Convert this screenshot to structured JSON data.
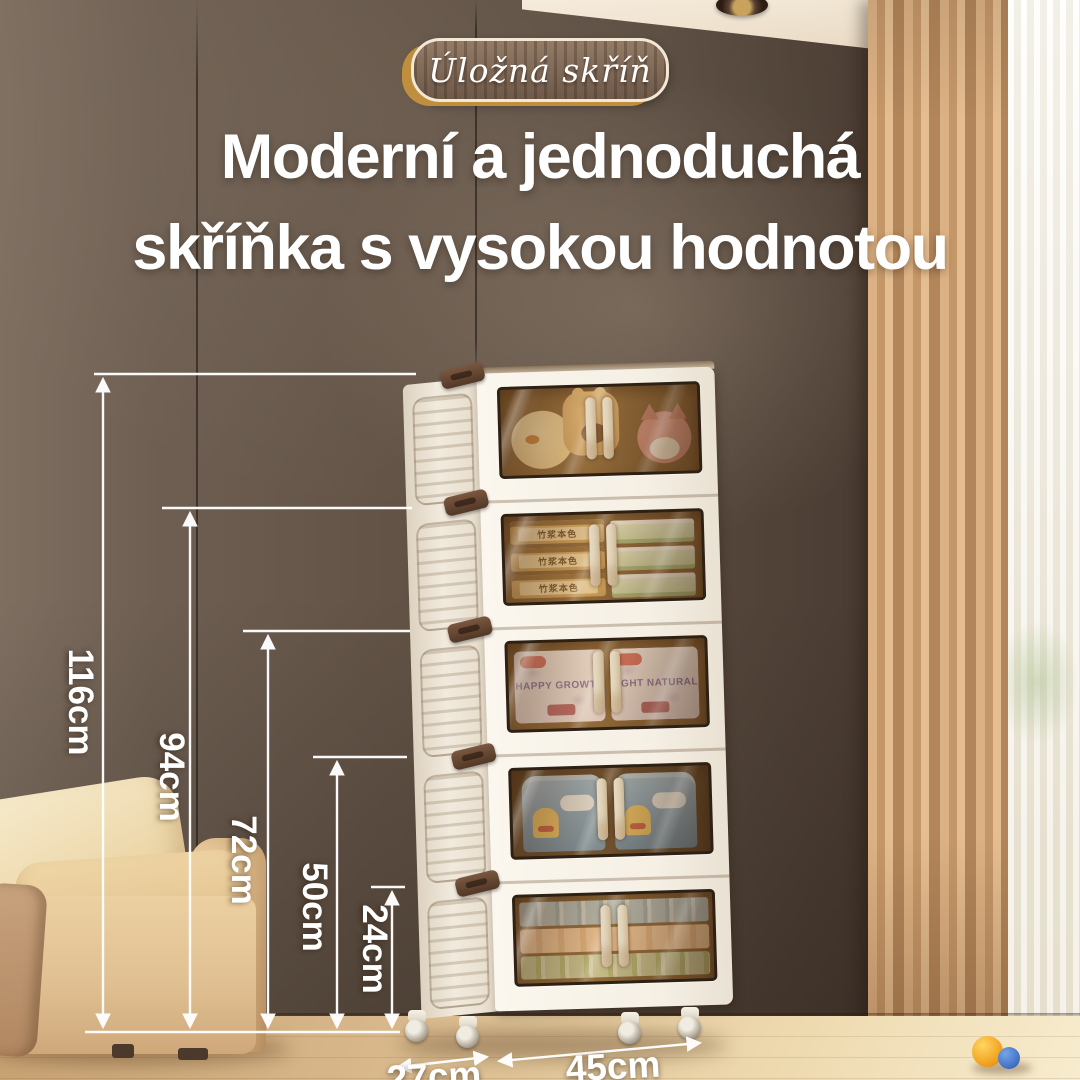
{
  "badge": {
    "label": "Úložná skříň"
  },
  "headline": {
    "line1": "Moderní a jednoduchá",
    "line2": "skříňka s vysokou hodnotou"
  },
  "dimensions": {
    "heights": [
      {
        "label": "116cm"
      },
      {
        "label": "94cm"
      },
      {
        "label": "72cm"
      },
      {
        "label": "50cm"
      },
      {
        "label": "24cm"
      }
    ],
    "depth": {
      "label": "27cm"
    },
    "width": {
      "label": "45cm"
    }
  },
  "cabinet": {
    "tier_count": 5,
    "tiers": [
      {
        "name": "plush-toys"
      },
      {
        "name": "tissue-packs",
        "pack_label": "竹浆本色"
      },
      {
        "name": "diaper-packs",
        "left_label": "HAPPY GROWTH",
        "right_label": "LIGHT NATURAL"
      },
      {
        "name": "milk-canisters"
      },
      {
        "name": "folded-quilts"
      }
    ]
  },
  "colors": {
    "wall": "#5d4e42",
    "curtain": "#c99d6f",
    "accent_gold": "#c08f3d",
    "cabinet_white": "#f7f2e9",
    "glass_amber": "#a87a44",
    "text": "#ffffff"
  }
}
